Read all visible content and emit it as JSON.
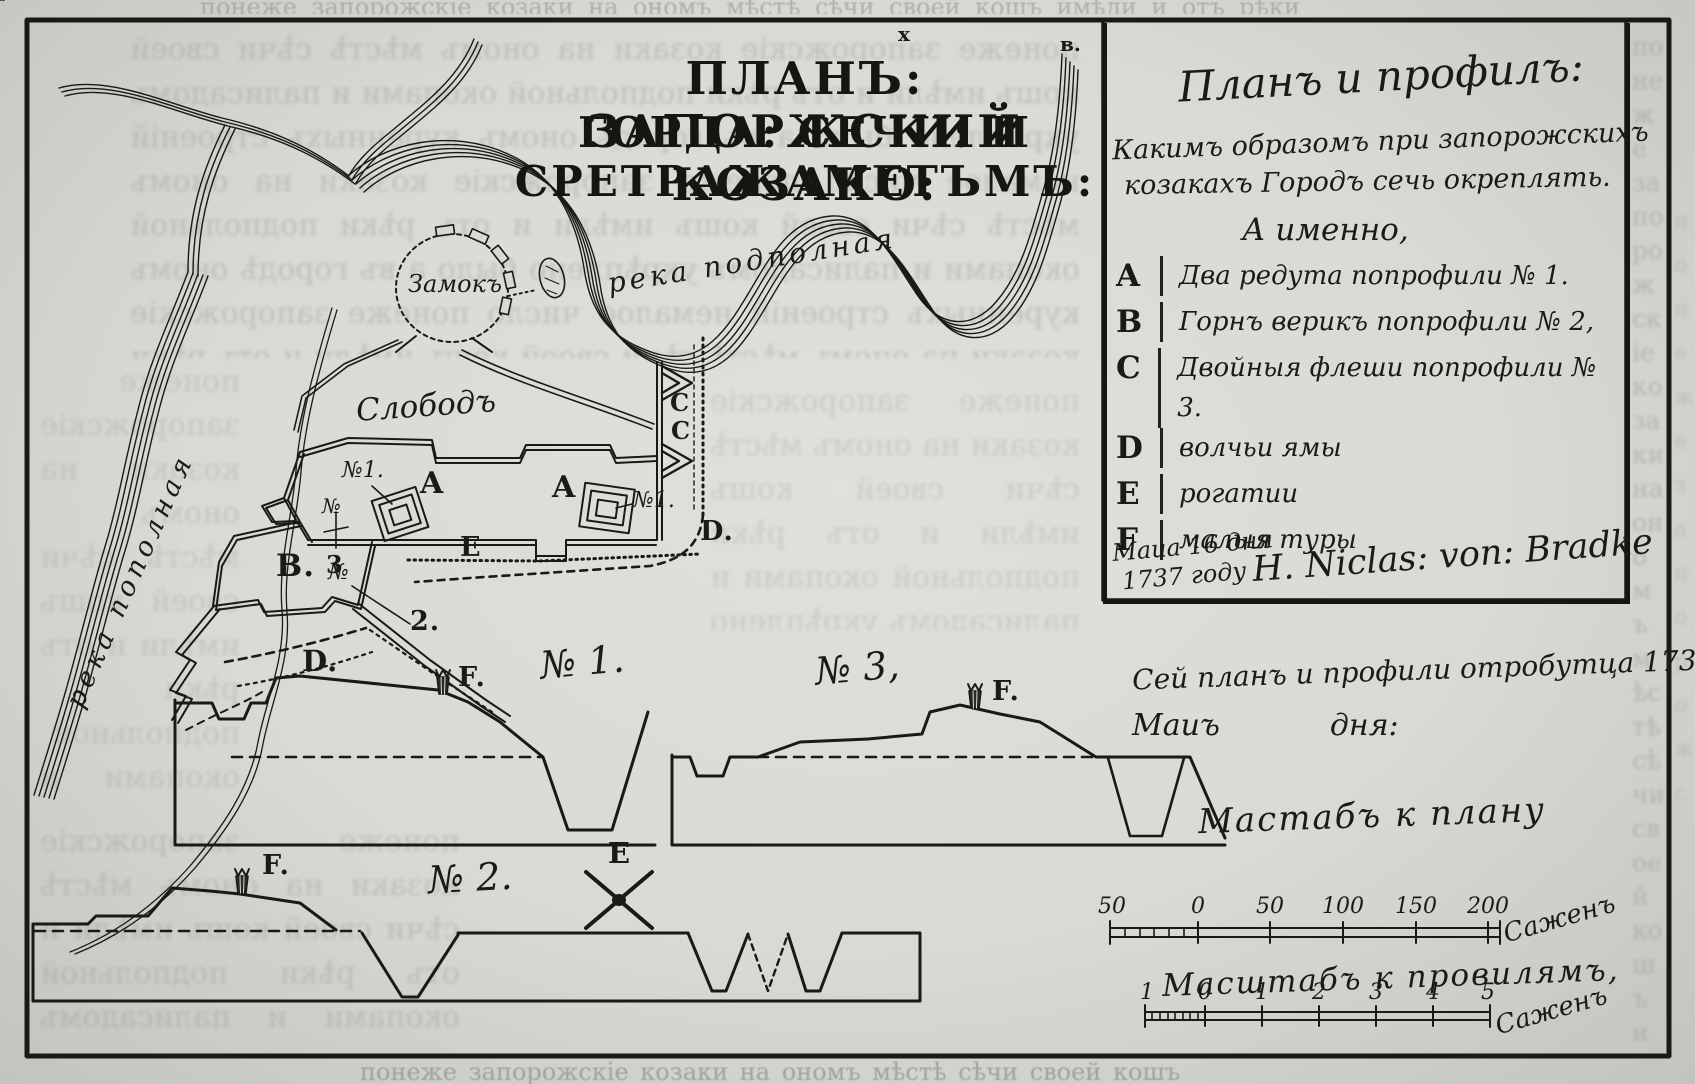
{
  "title": {
    "line1": "ПЛАНЪ: ЗАПОРЖСКИЙ КОЗАКО:",
    "line2": "ГОРДА: СЕЧИ: И СРЕТРАЖАМЕТЪМЪ:",
    "sup_left": "х",
    "sup_right": "в."
  },
  "map": {
    "castle_label": "Замокъ",
    "settlement_label": "Слободъ",
    "river_top_label": "река подполная",
    "river_left_label": "река пополная",
    "marker_a1": "A",
    "marker_a2": "A",
    "marker_n1a": "№1.",
    "marker_n1b": "№1.",
    "marker_b": "B.",
    "marker_c1": "C",
    "marker_c2": "C",
    "marker_d1": "D.",
    "marker_d2": "D.",
    "marker_e": "E",
    "marker_2": "2.",
    "marker_3": "3",
    "marker_no2": "№",
    "marker_no3": "№"
  },
  "legend": {
    "title": "Планъ и профилъ:",
    "subtitle_line1": "Какимъ образомъ при запорожскихъ",
    "subtitle_line2": "козакахъ Городъ сечь окреплять.",
    "items_heading": "А именно,",
    "items": [
      {
        "key": "A",
        "text": "Два редута попрофили № 1."
      },
      {
        "key": "B",
        "text": "Горнъ верикъ попрофили № 2,"
      },
      {
        "key": "C",
        "text": "Двойныя флеши попрофили № 3."
      },
      {
        "key": "D",
        "text": "волчьи ямы"
      },
      {
        "key": "E",
        "text": "рогатии"
      },
      {
        "key": "F",
        "text": "малыя туры"
      }
    ],
    "date_line1": "Маиа 16 дня",
    "date_line2": "1737 году",
    "signature": "H. Niclas: von: Bradke"
  },
  "note": {
    "line1": "Сей планъ и профили отробутца 1737 годъ",
    "line2_a": "Маиъ",
    "line2_b": "дня:"
  },
  "profiles": {
    "p1_label": "№ 1.",
    "p2_label": "№ 2.",
    "p3_label": "№ 3,",
    "f1": "F.",
    "f2": "F.",
    "f3": "F.",
    "e_label": "E"
  },
  "scales": {
    "plan": {
      "title": "Мастабъ к плану",
      "ticks": [
        "50",
        "0",
        "50",
        "100",
        "150",
        "200"
      ],
      "unit": "Саженъ"
    },
    "profile": {
      "title": "Масштабъ к провилямъ,",
      "ticks": [
        "1",
        "0",
        "1",
        "2",
        "3",
        "4",
        "5"
      ],
      "unit": "Саженъ"
    }
  },
  "bleedthrough_sample": "понеже запорожскіе козаки на ономъ мѣстѣ сѣчи своей кошъ имѣли и отъ рѣки подпольной окопами и палисадомъ укрѣплено было а въ городѣ ономъ куренныхъ строеній немалое число "
}
